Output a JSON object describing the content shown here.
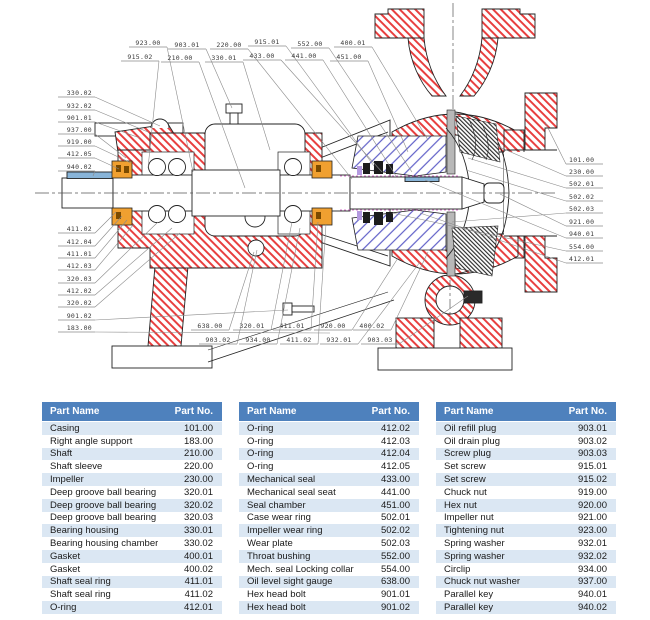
{
  "page": {
    "background": "#ffffff"
  },
  "diagram": {
    "title": "centrifugal pump sectional drawing",
    "colors": {
      "hatch_red": "#e84040",
      "hatch_blue": "#6060c8",
      "outline": "#222222",
      "leader_line": "#8a8a8a",
      "seal_ring_orange": "#f0a030",
      "parallel_key_blue": "#88b4d8",
      "wear_plate_gray": "#b8b8b8",
      "magenta_dash": "#cc50c0",
      "callout_text": "#3a3a3a"
    },
    "callouts": [
      {
        "label": "923.00",
        "x": 148,
        "y": 45,
        "align": "middle",
        "tx": 193,
        "ty": 172
      },
      {
        "label": "915.02",
        "x": 140,
        "y": 59,
        "align": "middle",
        "tx": 148,
        "ty": 168
      },
      {
        "label": "903.01",
        "x": 187,
        "y": 47,
        "align": "middle",
        "tx": 232,
        "ty": 108
      },
      {
        "label": "210.00",
        "x": 180,
        "y": 60,
        "align": "middle",
        "tx": 245,
        "ty": 188
      },
      {
        "label": "220.00",
        "x": 229,
        "y": 47,
        "align": "middle",
        "tx": 352,
        "ty": 179
      },
      {
        "label": "330.01",
        "x": 224,
        "y": 60,
        "align": "middle",
        "tx": 270,
        "ty": 150
      },
      {
        "label": "915.01",
        "x": 267,
        "y": 44,
        "align": "middle",
        "tx": 374,
        "ty": 166
      },
      {
        "label": "433.00",
        "x": 262,
        "y": 58,
        "align": "middle",
        "tx": 382,
        "ty": 172
      },
      {
        "label": "552.00",
        "x": 310,
        "y": 46,
        "align": "middle",
        "tx": 412,
        "ty": 172
      },
      {
        "label": "441.00",
        "x": 304,
        "y": 58,
        "align": "middle",
        "tx": 396,
        "ty": 176
      },
      {
        "label": "400.01",
        "x": 353,
        "y": 45,
        "align": "middle",
        "tx": 428,
        "ty": 140
      },
      {
        "label": "451.00",
        "x": 349,
        "y": 59,
        "align": "middle",
        "tx": 408,
        "ty": 152
      },
      {
        "label": "330.02",
        "x": 92,
        "y": 95,
        "align": "end",
        "tx": 160,
        "ty": 126
      },
      {
        "label": "932.02",
        "x": 92,
        "y": 108,
        "align": "end",
        "tx": 148,
        "ty": 132
      },
      {
        "label": "901.01",
        "x": 92,
        "y": 120,
        "align": "end",
        "tx": 140,
        "ty": 138
      },
      {
        "label": "937.00",
        "x": 92,
        "y": 132,
        "align": "end",
        "tx": 126,
        "ty": 158
      },
      {
        "label": "919.00",
        "x": 92,
        "y": 144,
        "align": "end",
        "tx": 131,
        "ty": 163
      },
      {
        "label": "412.05",
        "x": 92,
        "y": 156,
        "align": "end",
        "tx": 119,
        "ty": 169
      },
      {
        "label": "940.02",
        "x": 92,
        "y": 169,
        "align": "end",
        "tx": 93,
        "ty": 176
      },
      {
        "label": "411.02",
        "x": 92,
        "y": 231,
        "align": "end",
        "tx": 116,
        "ty": 212
      },
      {
        "label": "412.04",
        "x": 92,
        "y": 244,
        "align": "end",
        "tx": 122,
        "ty": 216
      },
      {
        "label": "411.01",
        "x": 92,
        "y": 256,
        "align": "end",
        "tx": 127,
        "ty": 220
      },
      {
        "label": "412.03",
        "x": 92,
        "y": 268,
        "align": "end",
        "tx": 134,
        "ty": 224
      },
      {
        "label": "320.03",
        "x": 92,
        "y": 281,
        "align": "end",
        "tx": 158,
        "ty": 222
      },
      {
        "label": "412.02",
        "x": 92,
        "y": 293,
        "align": "end",
        "tx": 172,
        "ty": 228
      },
      {
        "label": "320.02",
        "x": 92,
        "y": 305,
        "align": "end",
        "tx": 180,
        "ty": 233
      },
      {
        "label": "901.02",
        "x": 92,
        "y": 318,
        "align": "end",
        "tx": 288,
        "ty": 310
      },
      {
        "label": "183.00",
        "x": 92,
        "y": 330,
        "align": "end",
        "tx": 330,
        "ty": 333
      },
      {
        "label": "101.00",
        "x": 569,
        "y": 162,
        "align": "start",
        "tx": 545,
        "ty": 122
      },
      {
        "label": "230.00",
        "x": 569,
        "y": 174,
        "align": "start",
        "tx": 497,
        "ty": 146
      },
      {
        "label": "502.01",
        "x": 569,
        "y": 186,
        "align": "start",
        "tx": 468,
        "ty": 158
      },
      {
        "label": "502.02",
        "x": 569,
        "y": 199,
        "align": "start",
        "tx": 466,
        "ty": 170
      },
      {
        "label": "502.03",
        "x": 569,
        "y": 211,
        "align": "start",
        "tx": 452,
        "ty": 222
      },
      {
        "label": "921.00",
        "x": 569,
        "y": 224,
        "align": "start",
        "tx": 500,
        "ty": 194
      },
      {
        "label": "940.01",
        "x": 569,
        "y": 236,
        "align": "start",
        "tx": 425,
        "ty": 180
      },
      {
        "label": "554.00",
        "x": 569,
        "y": 249,
        "align": "start",
        "tx": 392,
        "ty": 213
      },
      {
        "label": "412.01",
        "x": 569,
        "y": 261,
        "align": "start",
        "tx": 420,
        "ty": 213
      },
      {
        "label": "638.00",
        "x": 210,
        "y": 328,
        "align": "middle",
        "tx": 254,
        "ty": 252
      },
      {
        "label": "320.01",
        "x": 252,
        "y": 328,
        "align": "middle",
        "tx": 292,
        "ty": 222
      },
      {
        "label": "411.01",
        "x": 292,
        "y": 328,
        "align": "middle",
        "tx": 318,
        "ty": 222
      },
      {
        "label": "920.00",
        "x": 333,
        "y": 328,
        "align": "middle",
        "tx": 398,
        "ty": 258
      },
      {
        "label": "400.02",
        "x": 372,
        "y": 328,
        "align": "middle",
        "tx": 428,
        "ty": 252
      },
      {
        "label": "903.02",
        "x": 218,
        "y": 342,
        "align": "middle",
        "tx": 257,
        "ty": 250
      },
      {
        "label": "934.00",
        "x": 258,
        "y": 342,
        "align": "middle",
        "tx": 300,
        "ty": 228
      },
      {
        "label": "411.02",
        "x": 299,
        "y": 342,
        "align": "middle",
        "tx": 326,
        "ty": 224
      },
      {
        "label": "932.01",
        "x": 339,
        "y": 342,
        "align": "middle",
        "tx": 420,
        "ty": 262
      },
      {
        "label": "903.03",
        "x": 380,
        "y": 342,
        "align": "middle",
        "tx": 468,
        "ty": 296
      }
    ]
  },
  "table_style": {
    "header_bg": "#4e81bd",
    "header_text": "#ffffff",
    "band_bg": "#dbe7f3",
    "row_text": "#1a1a1a"
  },
  "tables": [
    {
      "headers": [
        "Part Name",
        "Part No."
      ],
      "rows": [
        [
          "Casing",
          "101.00"
        ],
        [
          "Right angle support",
          "183.00"
        ],
        [
          "Shaft",
          "210.00"
        ],
        [
          "Shaft sleeve",
          "220.00"
        ],
        [
          "Impeller",
          "230.00"
        ],
        [
          "Deep groove ball bearing",
          "320.01"
        ],
        [
          "Deep groove ball bearing",
          "320.02"
        ],
        [
          "Deep groove ball bearing",
          "320.03"
        ],
        [
          "Bearing housing",
          "330.01"
        ],
        [
          "Bearing housing chamber",
          "330.02"
        ],
        [
          "Gasket",
          "400.01"
        ],
        [
          "Gasket",
          "400.02"
        ],
        [
          "Shaft seal ring",
          "411.01"
        ],
        [
          "Shaft seal ring",
          "411.02"
        ],
        [
          "O-ring",
          "412.01"
        ]
      ]
    },
    {
      "headers": [
        "Part Name",
        "Part No."
      ],
      "rows": [
        [
          "O-ring",
          "412.02"
        ],
        [
          "O-ring",
          "412.03"
        ],
        [
          "O-ring",
          "412.04"
        ],
        [
          "O-ring",
          "412.05"
        ],
        [
          "Mechanical seal",
          "433.00"
        ],
        [
          "Mechanical seal seat",
          "441.00"
        ],
        [
          "Seal chamber",
          "451.00"
        ],
        [
          "Case wear ring",
          "502.01"
        ],
        [
          "Impeller wear ring",
          "502.02"
        ],
        [
          "Wear plate",
          "502.03"
        ],
        [
          "Throat bushing",
          "552.00"
        ],
        [
          "Mech. seal Locking collar",
          "554.00"
        ],
        [
          "Oil level sight gauge",
          "638.00"
        ],
        [
          "Hex head bolt",
          "901.01"
        ],
        [
          "Hex head bolt",
          "901.02"
        ]
      ]
    },
    {
      "headers": [
        "Part Name",
        "Part No."
      ],
      "rows": [
        [
          "Oil refill plug",
          "903.01"
        ],
        [
          "Oil drain plug",
          "903.02"
        ],
        [
          "Screw plug",
          "903.03"
        ],
        [
          "Set screw",
          "915.01"
        ],
        [
          "Set screw",
          "915.02"
        ],
        [
          "Chuck nut",
          "919.00"
        ],
        [
          "Hex nut",
          "920.00"
        ],
        [
          "Impeller nut",
          "921.00"
        ],
        [
          "Tightening nut",
          "923.00"
        ],
        [
          "Spring washer",
          "932.01"
        ],
        [
          "Spring washer",
          "932.02"
        ],
        [
          "Circlip",
          "934.00"
        ],
        [
          "Chuck nut washer",
          "937.00"
        ],
        [
          "Parallel key",
          "940.01"
        ],
        [
          "Parallel key",
          "940.02"
        ]
      ]
    }
  ]
}
